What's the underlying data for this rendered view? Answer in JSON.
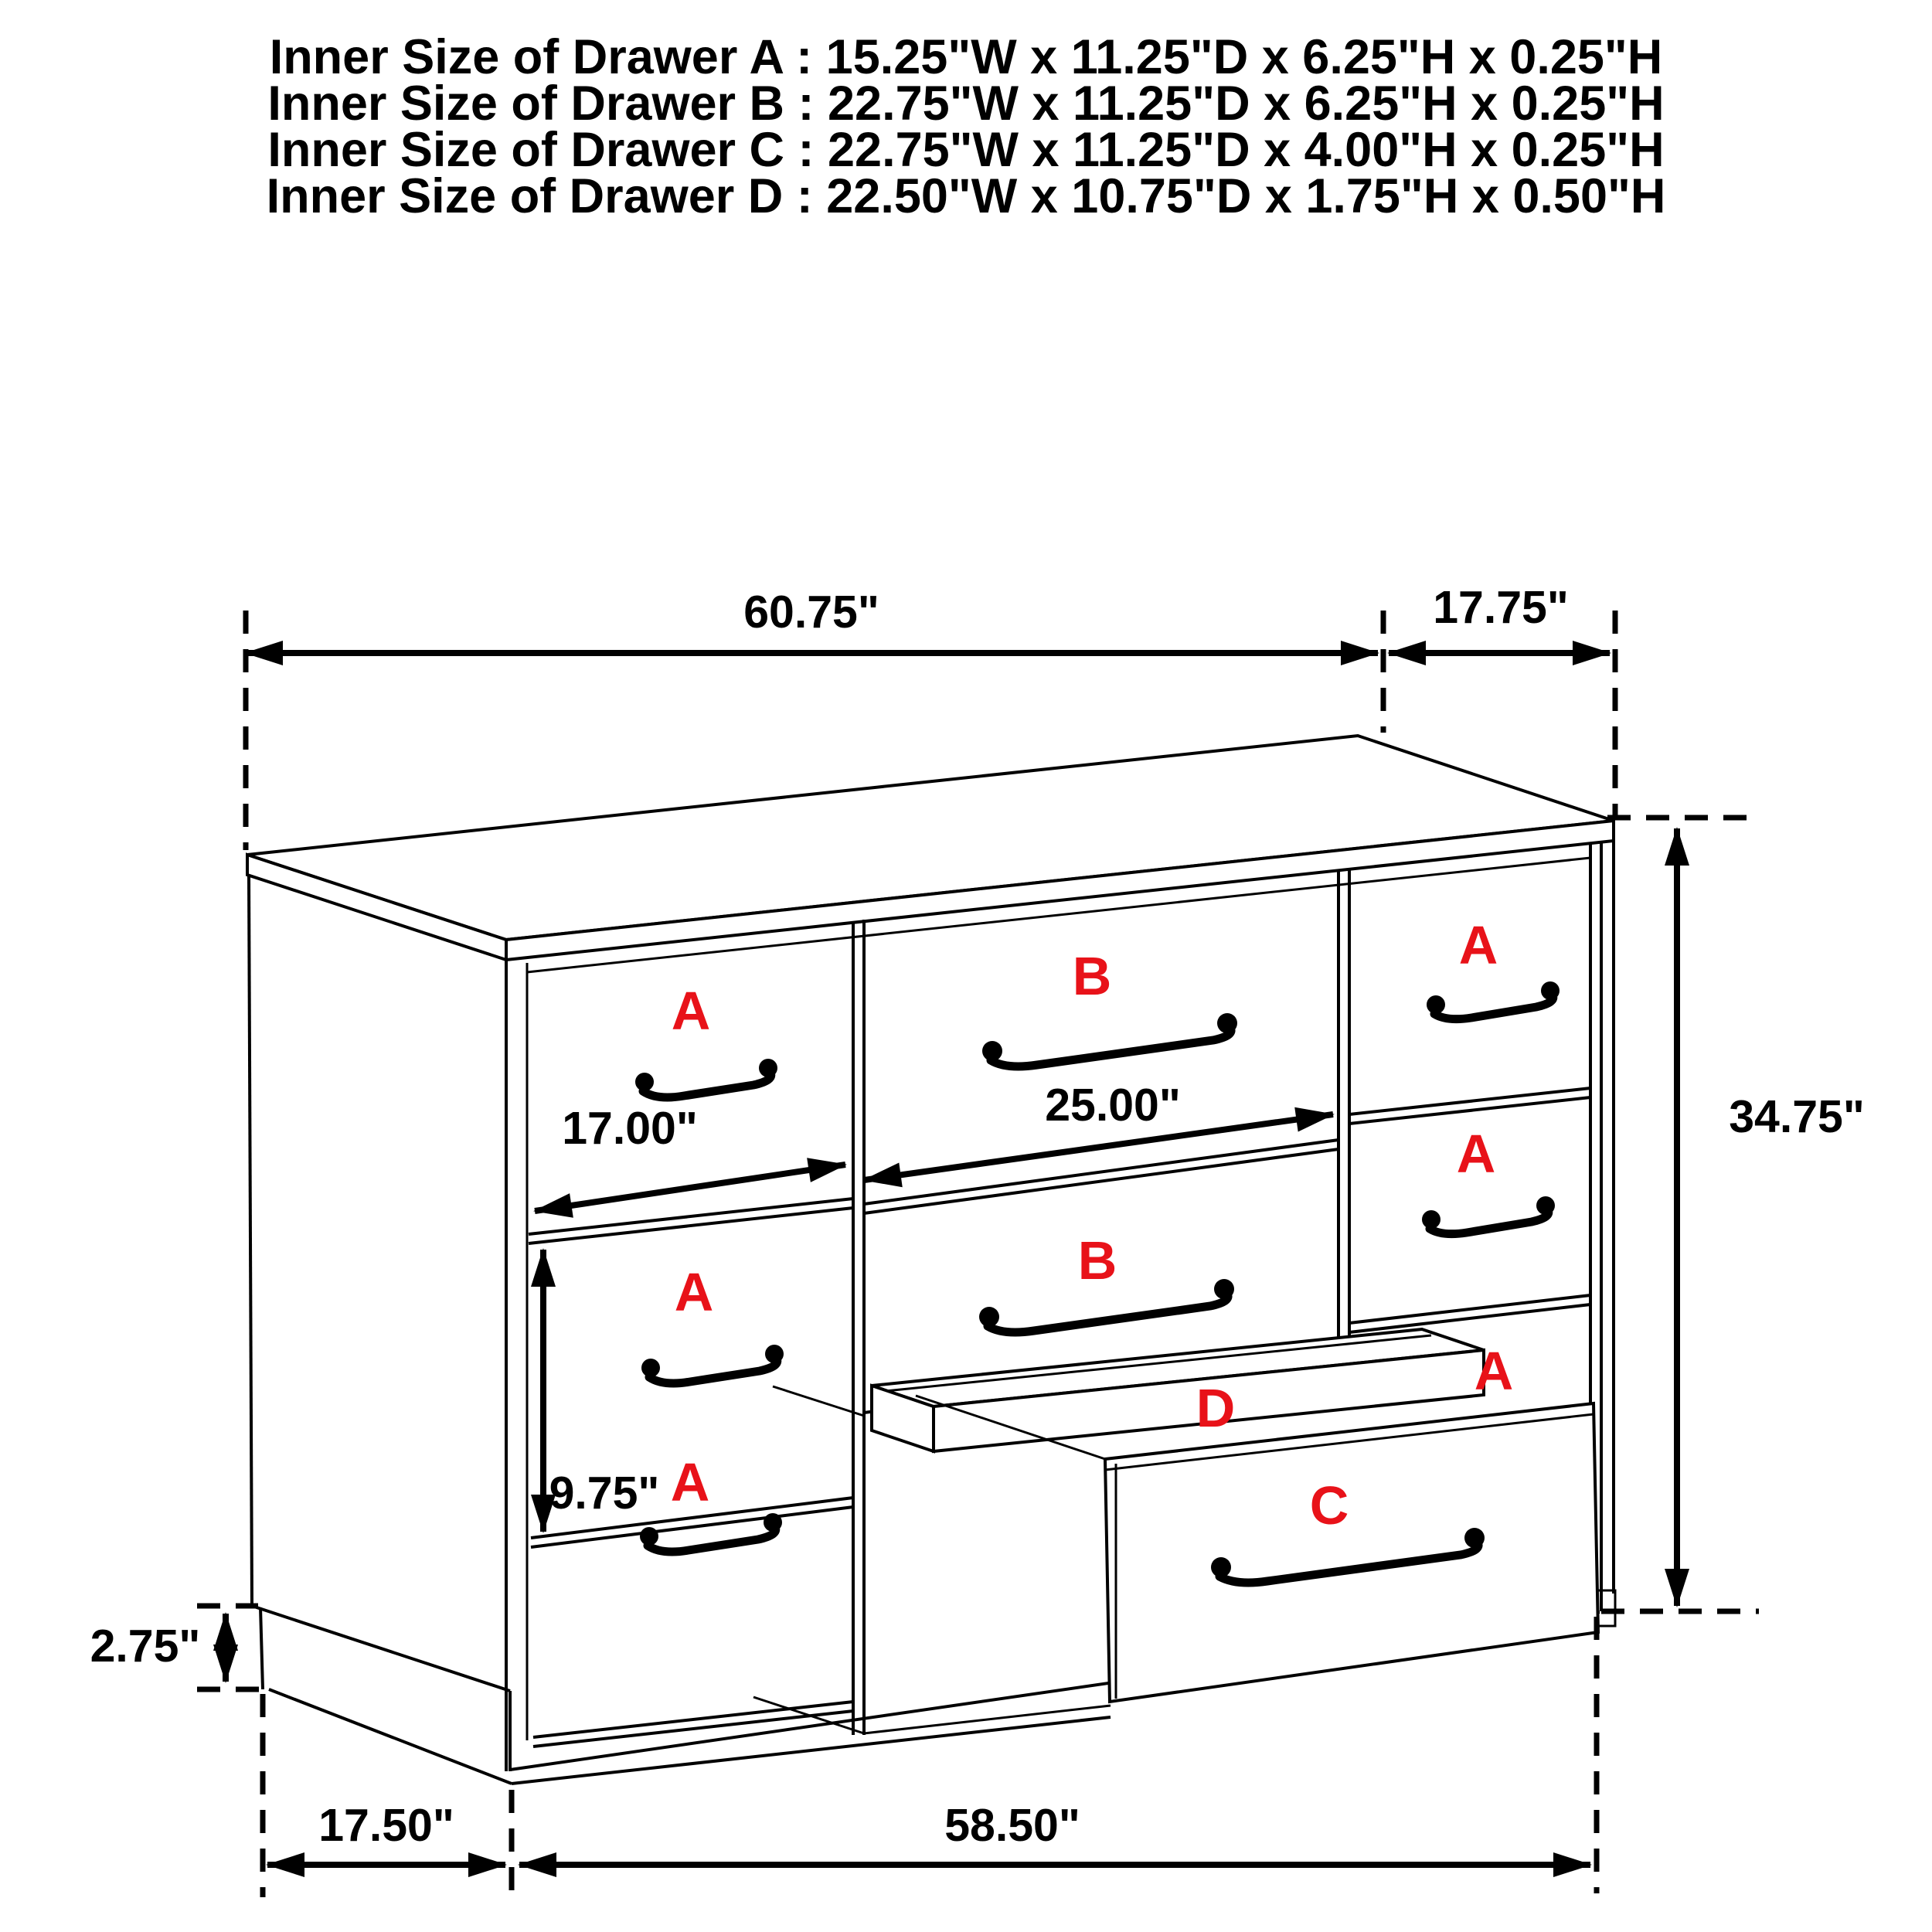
{
  "title_block": {
    "lines": [
      "Inner Size of Drawer A : 15.25\"W x 11.25\"D x 6.25\"H x 0.25\"H",
      "Inner Size of Drawer B : 22.75\"W x 11.25\"D x 6.25\"H x 0.25\"H",
      "Inner Size of Drawer C : 22.75\"W x 11.25\"D x 4.00\"H x 0.25\"H",
      "Inner Size of Drawer  D : 22.50\"W x 10.75\"D x 1.75\"H x 0.50\"H"
    ]
  },
  "dimensions": {
    "top_width": "60.75\"",
    "top_depth": "17.75\"",
    "overall_height": "34.75\"",
    "left_opening_width": "17.00\"",
    "middle_opening_width": "25.00\"",
    "left_opening_height": "9.75\"",
    "base_height": "2.75\"",
    "bottom_depth": "17.50\"",
    "bottom_width": "58.50\""
  },
  "drawer_labels": {
    "left_column": [
      "A",
      "A",
      "A"
    ],
    "right_column": [
      "A",
      "A",
      "A"
    ],
    "middle_column": [
      "B",
      "B"
    ],
    "tray": "D",
    "bottom_drawer": "C"
  },
  "colors": {
    "line": "#000000",
    "label_red": "#e81219",
    "background": "#ffffff"
  }
}
